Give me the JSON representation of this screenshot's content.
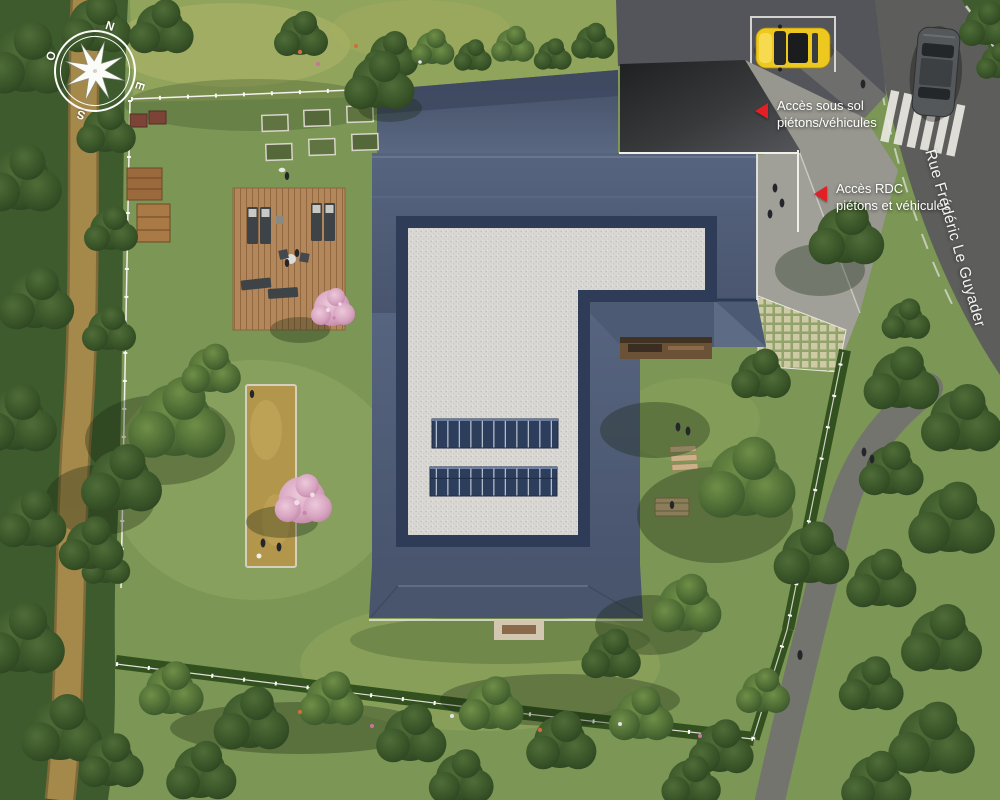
{
  "site_plan": {
    "compass": {
      "north": "N",
      "east": "E",
      "south": "S",
      "west": "O"
    },
    "street": {
      "name": "Rue Frédéric Le Guyader"
    },
    "annotations": {
      "basement_access": {
        "line1": "Accès sous sol",
        "line2": "piétons/véhicules"
      },
      "ground_access": {
        "line1": "Accès RDC",
        "line2": "piétons et véhicules"
      }
    },
    "colors": {
      "annotation_red": "#e31e24",
      "label_text": "#ffffff",
      "grass": "#7b9655",
      "road": "#5d5e5b",
      "roof_slate": "#52607b",
      "roof_gravel": "#d8d7d3",
      "solar_panel": "#2d3e5d",
      "deck_wood": "#b2875b",
      "dirt_path": "#a4894a",
      "car_yellow": "#edc91f"
    }
  }
}
